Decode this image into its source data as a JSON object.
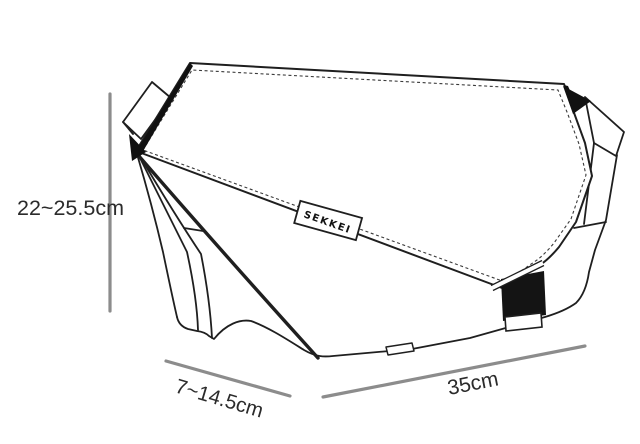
{
  "diagram": {
    "type": "product-dimension-diagram",
    "subject": "sling-bag-technical-line-drawing",
    "brand_label": "SEKKEI",
    "dimensions": {
      "height_range": "22~25.5cm",
      "depth_range": "7~14.5cm",
      "width": "35cm"
    },
    "colors": {
      "outline": "#1f1f1f",
      "stitch": "#3a3a3a",
      "dimension_line": "#8c8c8c",
      "text": "#2b2b2b",
      "buckle_fill": "#141414",
      "background": "#ffffff"
    }
  }
}
